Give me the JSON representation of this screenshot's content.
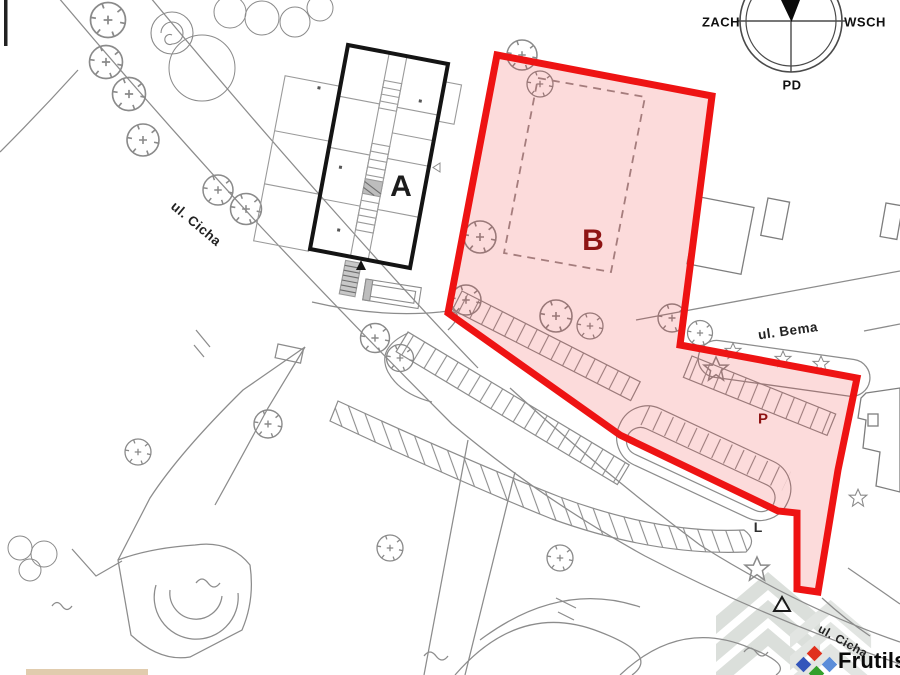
{
  "labels": {
    "building_a": "A",
    "zone_b": "B",
    "parking": "P",
    "l_marker": "L"
  },
  "streets": {
    "cicha_upper": "ul. Cicha",
    "cicha_lower": "ul. Cicha",
    "bema": "ul. Bema"
  },
  "compass": {
    "west": "ZACH",
    "east": "WSCH",
    "south": "PD"
  },
  "watermark": {
    "brand": "Frutils"
  },
  "colors": {
    "zone_outline": "#ee1313",
    "zone_fill": "#ec2121",
    "zone_label": "#8e1414",
    "dashed_rect": "#a57d7d",
    "line_gray": "#8c8c8c",
    "building_outline": "#141414",
    "logo_red": "#e0301e",
    "logo_blue_dark": "#3355bb",
    "logo_blue_light": "#5b8dd9",
    "logo_green": "#33a02c"
  }
}
